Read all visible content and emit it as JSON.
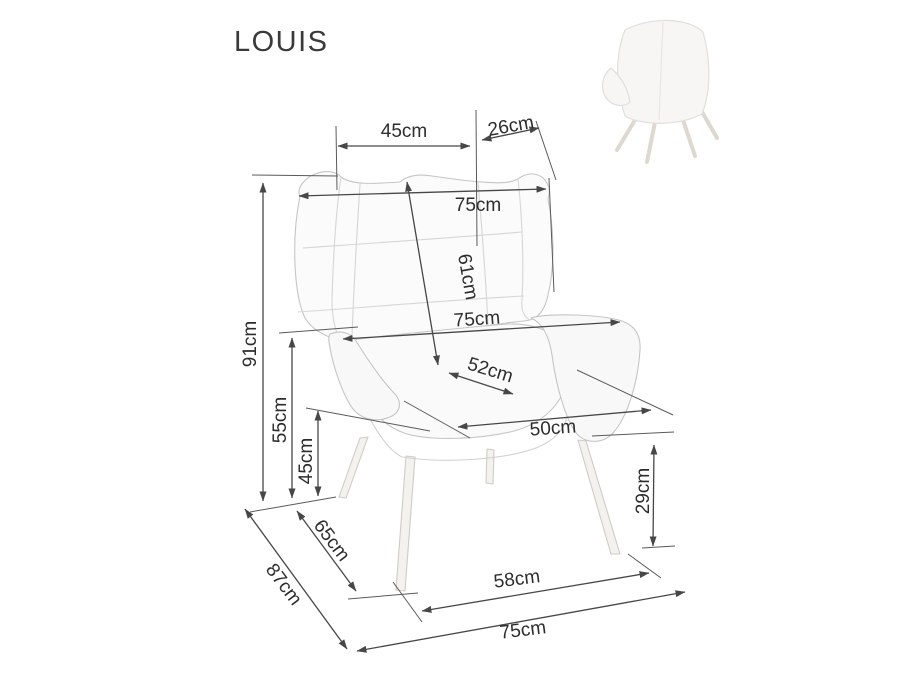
{
  "title": "LOUIS",
  "thumbnail": {
    "description": "chair rear view photo"
  },
  "dimensions": {
    "seat_top_width": "45cm",
    "wing_depth_top": "26cm",
    "back_top_width": "75cm",
    "backrest_height": "61cm",
    "armrest_level_width": "75cm",
    "seat_depth": "52cm",
    "seat_width": "50cm",
    "total_height": "91cm",
    "armrest_height": "55cm",
    "seat_height": "45cm",
    "side_feet_depth": "65cm",
    "total_depth": "87cm",
    "leg_height": "29cm",
    "front_feet_width": "58cm",
    "total_width": "75cm"
  },
  "colors": {
    "dimension_line": "#474747",
    "label_text": "#2d2d2d",
    "chair_outline": "#c5c5c5",
    "background": "#ffffff"
  }
}
